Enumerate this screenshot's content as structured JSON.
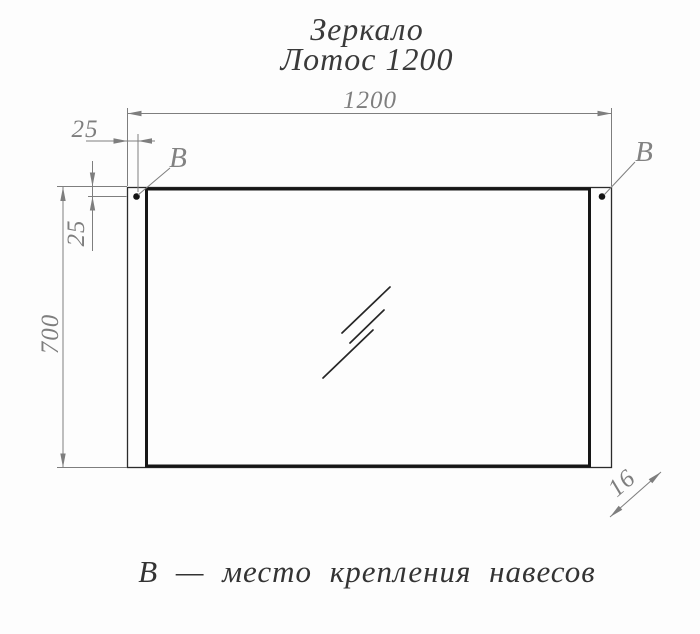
{
  "title": {
    "line1": "Зеркало",
    "line2": "Лотос 1200"
  },
  "dimensions": {
    "width_mm": "1200",
    "height_mm": "700",
    "mount_offset_top_mm": "25",
    "mount_offset_side_mm": "25",
    "thickness_mm": "16"
  },
  "labels": {
    "mount_point_left": "B",
    "mount_point_right": "B",
    "legend": "В — место крепления навесов"
  },
  "colors": {
    "outline_dark": "#2b2b2b",
    "glass_dark": "#161616",
    "dimension_gray": "#7e7e7e",
    "text_dark": "#3a3a3a",
    "background": "#fdfdfd"
  }
}
